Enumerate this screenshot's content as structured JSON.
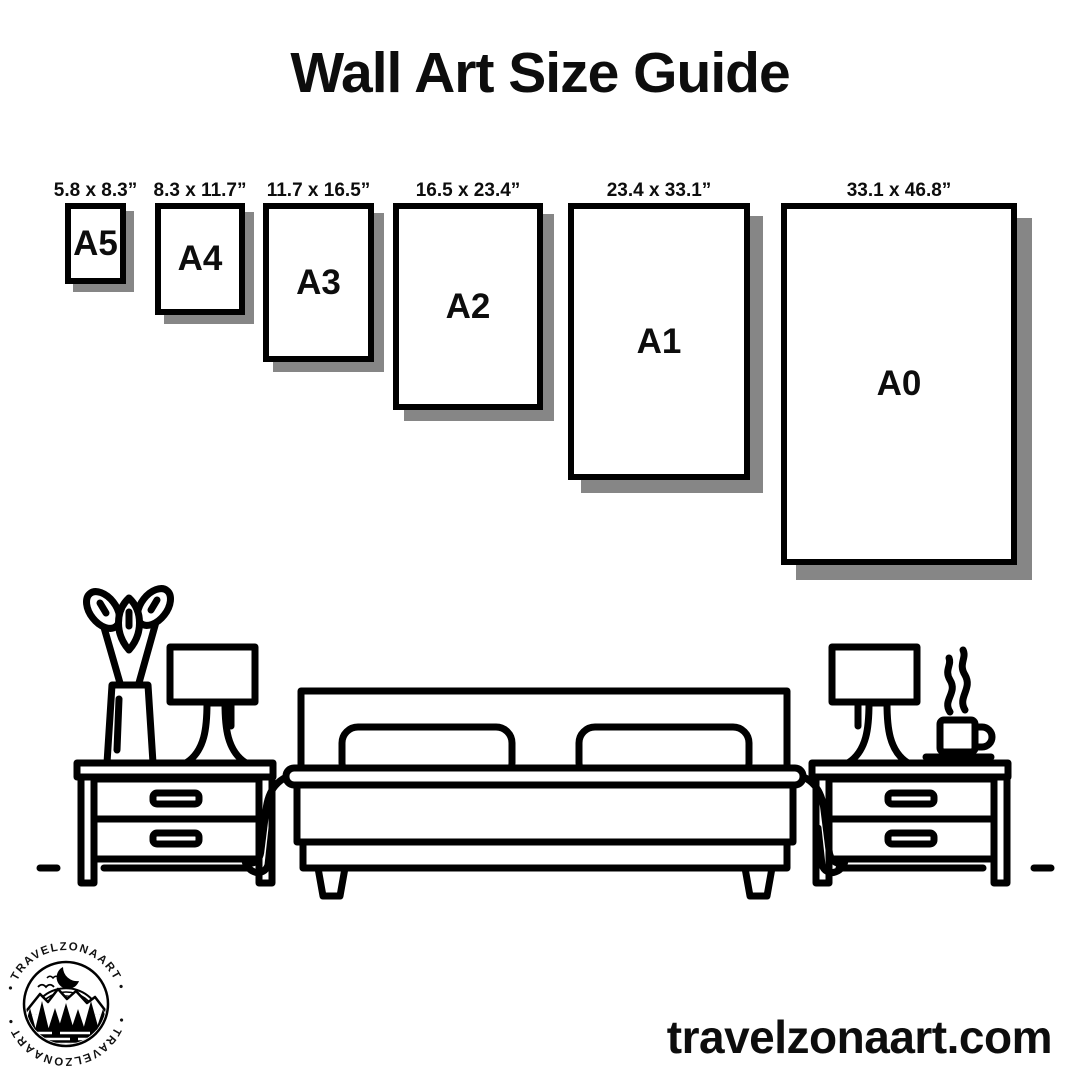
{
  "page": {
    "title": "Wall Art Size Guide",
    "website": "travelzonaart.com"
  },
  "sizes": [
    {
      "code": "A5",
      "inches": "5.8 x 8.3”"
    },
    {
      "code": "A4",
      "inches": "8.3 x 11.7”"
    },
    {
      "code": "A3",
      "inches": "11.7 x 16.5”"
    },
    {
      "code": "A2",
      "inches": "16.5 x 23.4”"
    },
    {
      "code": "A1",
      "inches": "23.4 x 33.1”"
    },
    {
      "code": "A0",
      "inches": "33.1 x 46.8”"
    }
  ],
  "logo": {
    "brand": "TRAVELZONAART",
    "arc_top": "• TRAVELZONAART •",
    "arc_bottom": "• TRAVELZONAART •"
  },
  "colors": {
    "ink": "#000000",
    "paper_shadow": "#868686",
    "background": "#ffffff"
  }
}
